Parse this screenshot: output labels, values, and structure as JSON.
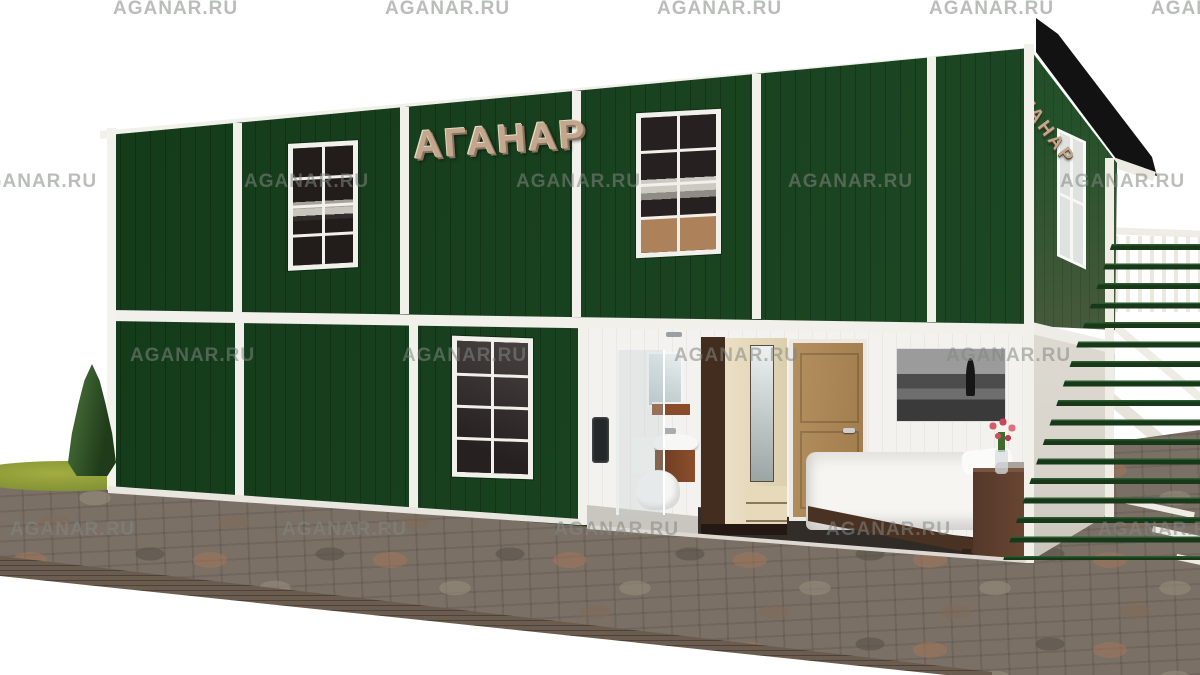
{
  "scene": {
    "type": "3d-product-render",
    "subject": "two-storey modular container building, dark green siding with white trim, cutaway showing bathroom, wardrobe hallway and bedroom, external white staircase and green slat fence, paver platform, conifer bush",
    "width_px": 1200,
    "height_px": 675
  },
  "building": {
    "sign_front": "АГАНАР",
    "sign_side": "АГАНАР",
    "storeys": 2,
    "front_windows": 3,
    "side_windows": 1
  },
  "watermark": {
    "text": "AGANAR.RU",
    "instances": [
      [
        113,
        -2
      ],
      [
        385,
        -2
      ],
      [
        657,
        -2
      ],
      [
        929,
        -2
      ],
      [
        1151,
        -2
      ],
      [
        -28,
        171
      ],
      [
        244,
        171
      ],
      [
        516,
        171
      ],
      [
        788,
        171
      ],
      [
        1060,
        171
      ],
      [
        130,
        345
      ],
      [
        402,
        345
      ],
      [
        674,
        345
      ],
      [
        946,
        345
      ],
      [
        10,
        519
      ],
      [
        282,
        519
      ],
      [
        554,
        519
      ],
      [
        826,
        519
      ],
      [
        1098,
        519
      ]
    ]
  },
  "colors": {
    "bg": "#ffffff",
    "facade-green": "#16431d",
    "roof": "#121212",
    "trim-white": "#f2f0ea",
    "sign-tan": "#c2a78c",
    "side-wall-top": "#1d441f",
    "side-wall-bottom": "#a18a66",
    "fence-green": "#17391a",
    "pavement": "#7b7066",
    "pavement-edge": "#6a5c4e",
    "grass": "#a2ad41",
    "bush": "#1f3b19",
    "interior-wall": "#f3f2ee",
    "floor-dark": "#3f3833",
    "wood-door": "#b4905f",
    "wardrobe-cream": "#ecdfc5",
    "wardrobe-walnut": "#432d1f",
    "watermark-color": "rgba(130,135,130,0.55)"
  }
}
